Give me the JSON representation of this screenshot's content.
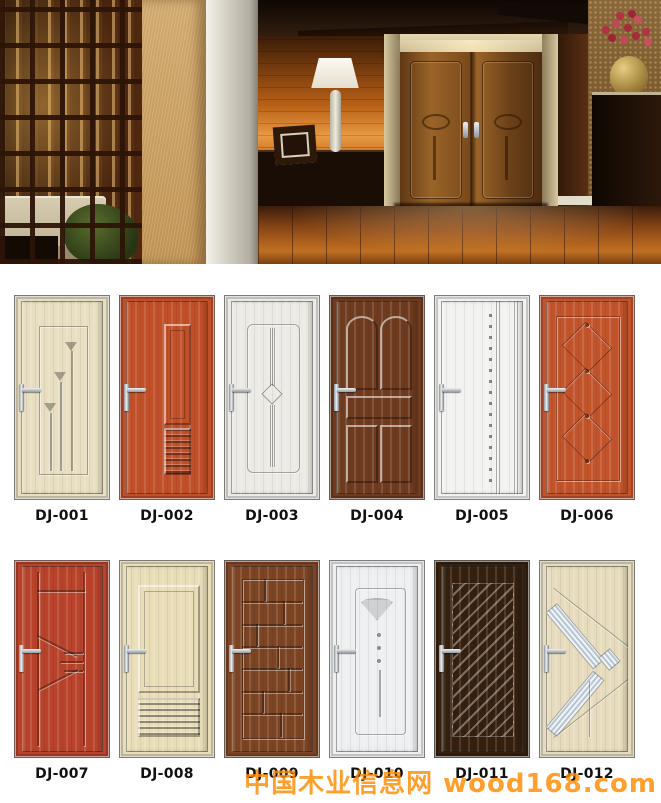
{
  "catalog": {
    "doors": [
      {
        "code": "DJ-001",
        "color": "#e8dfc2"
      },
      {
        "code": "DJ-002",
        "color": "#c14f28"
      },
      {
        "code": "DJ-003",
        "color": "#eceae4"
      },
      {
        "code": "DJ-004",
        "color": "#6e3b1f"
      },
      {
        "code": "DJ-005",
        "color": "#f2f2f0"
      },
      {
        "code": "DJ-006",
        "color": "#c2542c"
      },
      {
        "code": "DJ-007",
        "color": "#b8432a"
      },
      {
        "code": "DJ-008",
        "color": "#e9ddb8"
      },
      {
        "code": "DJ-009",
        "color": "#7c4423"
      },
      {
        "code": "DJ-010",
        "color": "#edeff0"
      },
      {
        "code": "DJ-011",
        "color": "#35200f"
      },
      {
        "code": "DJ-012",
        "color": "#e6dcbd"
      }
    ]
  },
  "watermark": {
    "text": "中国木业信息网 wood168.com",
    "color": "#ff8a00"
  }
}
